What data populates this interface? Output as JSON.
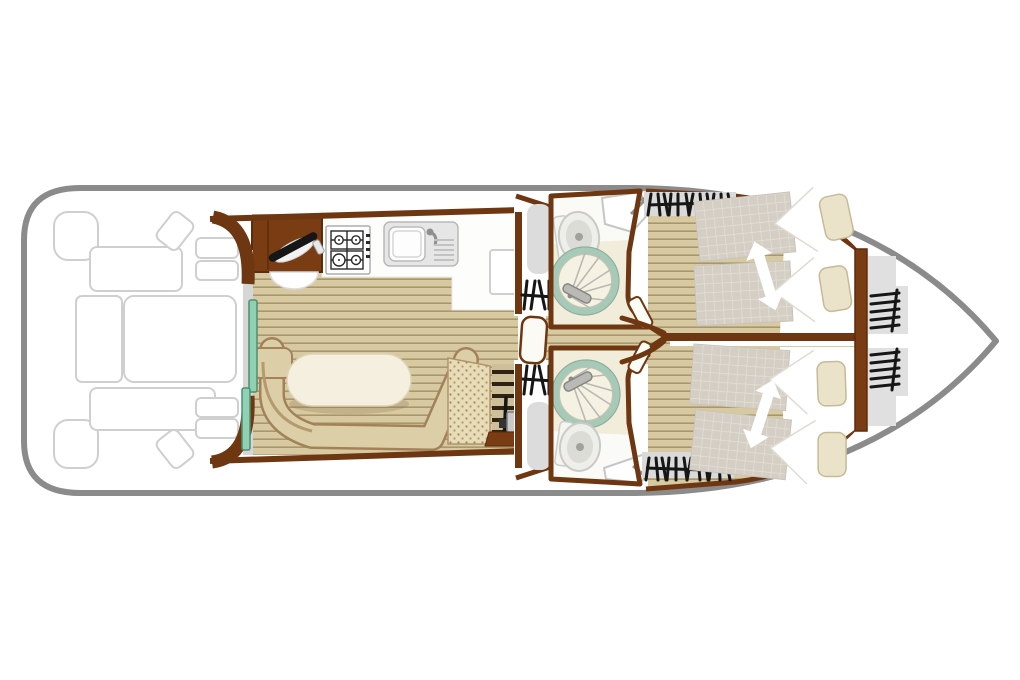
{
  "deck_plan": {
    "label": "boat-deck-floor-plan",
    "hull": {
      "label": "hull-outline",
      "stroke": "#8b8b8b",
      "fill": "#ffffff",
      "bow_side": "right",
      "stern_side": "left"
    },
    "stern_deck": {
      "label": "stern-deck-outdoor-seating",
      "items": [
        "corner-seat",
        "corner-seat",
        "deck-bench",
        "deck-bench",
        "deck-table-left",
        "deck-table-right",
        "swivel-seat",
        "swivel-seat",
        "boarding-step",
        "boarding-step",
        "boarding-step",
        "boarding-step"
      ]
    },
    "aft_entry": {
      "label": "aft-sliding-door",
      "panels": 2,
      "door_color": "#8fd2b3",
      "track_color": "#d6d6d6"
    },
    "galley": {
      "label": "galley",
      "items": [
        "storage-cabinet",
        "utensil-icon",
        "cabinet-door-swing",
        "gas-hob-4-burner",
        "sink-with-drainer-and-tap",
        "under-counter-locker"
      ]
    },
    "saloon": {
      "label": "saloon-dinette",
      "items": [
        "u-shaped-bench",
        "oval-table",
        "textured-bench",
        "companionway-steps",
        "steering-wheel",
        "step-box"
      ]
    },
    "side_entries": [
      {
        "label": "side-entry-top",
        "items": [
          "sliding-hatch-pad",
          "steps-hatch-icon"
        ]
      },
      {
        "label": "side-entry-bottom",
        "items": [
          "steps-hatch-icon",
          "sliding-hatch-pad"
        ]
      }
    ],
    "corridor": {
      "label": "central-corridor",
      "items": [
        "corridor-door-leaf",
        "partition-wall",
        "door-stop-fork"
      ]
    },
    "bathrooms": [
      {
        "label": "bathroom-top",
        "fixtures": [
          "toilet",
          "washbasin-with-tap",
          "circular-shower"
        ]
      },
      {
        "label": "bathroom-bottom",
        "fixtures": [
          "circular-shower",
          "toilet",
          "washbasin-with-tap"
        ]
      }
    ],
    "cabins": [
      {
        "label": "cabin-top",
        "features": [
          "sliding-twin-beds",
          "bed-slide-arrow",
          "pillow",
          "pillow",
          "hull-window-hatch"
        ]
      },
      {
        "label": "cabin-bottom",
        "features": [
          "sliding-twin-beds",
          "bed-slide-arrow",
          "pillow",
          "pillow",
          "hull-window-hatch"
        ]
      }
    ],
    "bow": {
      "label": "bow-deck",
      "items": [
        "step-block",
        "step-block",
        "ladder-icon",
        "ladder-icon"
      ]
    },
    "colors": {
      "wall_brown": "#6e3712",
      "cabinet_brown": "#7a3c12",
      "wood_base": "#d7c9a2",
      "plank_line": "#a9946a",
      "bench_tan": "#dccfa8",
      "bench_edge": "#a3825a",
      "table_cream": "#f4efde",
      "teal_door": "#8fd2b3",
      "mattress_gray": "#d4cec4",
      "pillow_beige": "#ebe3c9",
      "bath_floor": "#f2ecdb",
      "shower_ring_teal": "#a7cab8",
      "fixture_gray": "#dcdcdc",
      "hatch_black": "#161616",
      "deck_outline_gray": "#cfcfcf"
    }
  }
}
